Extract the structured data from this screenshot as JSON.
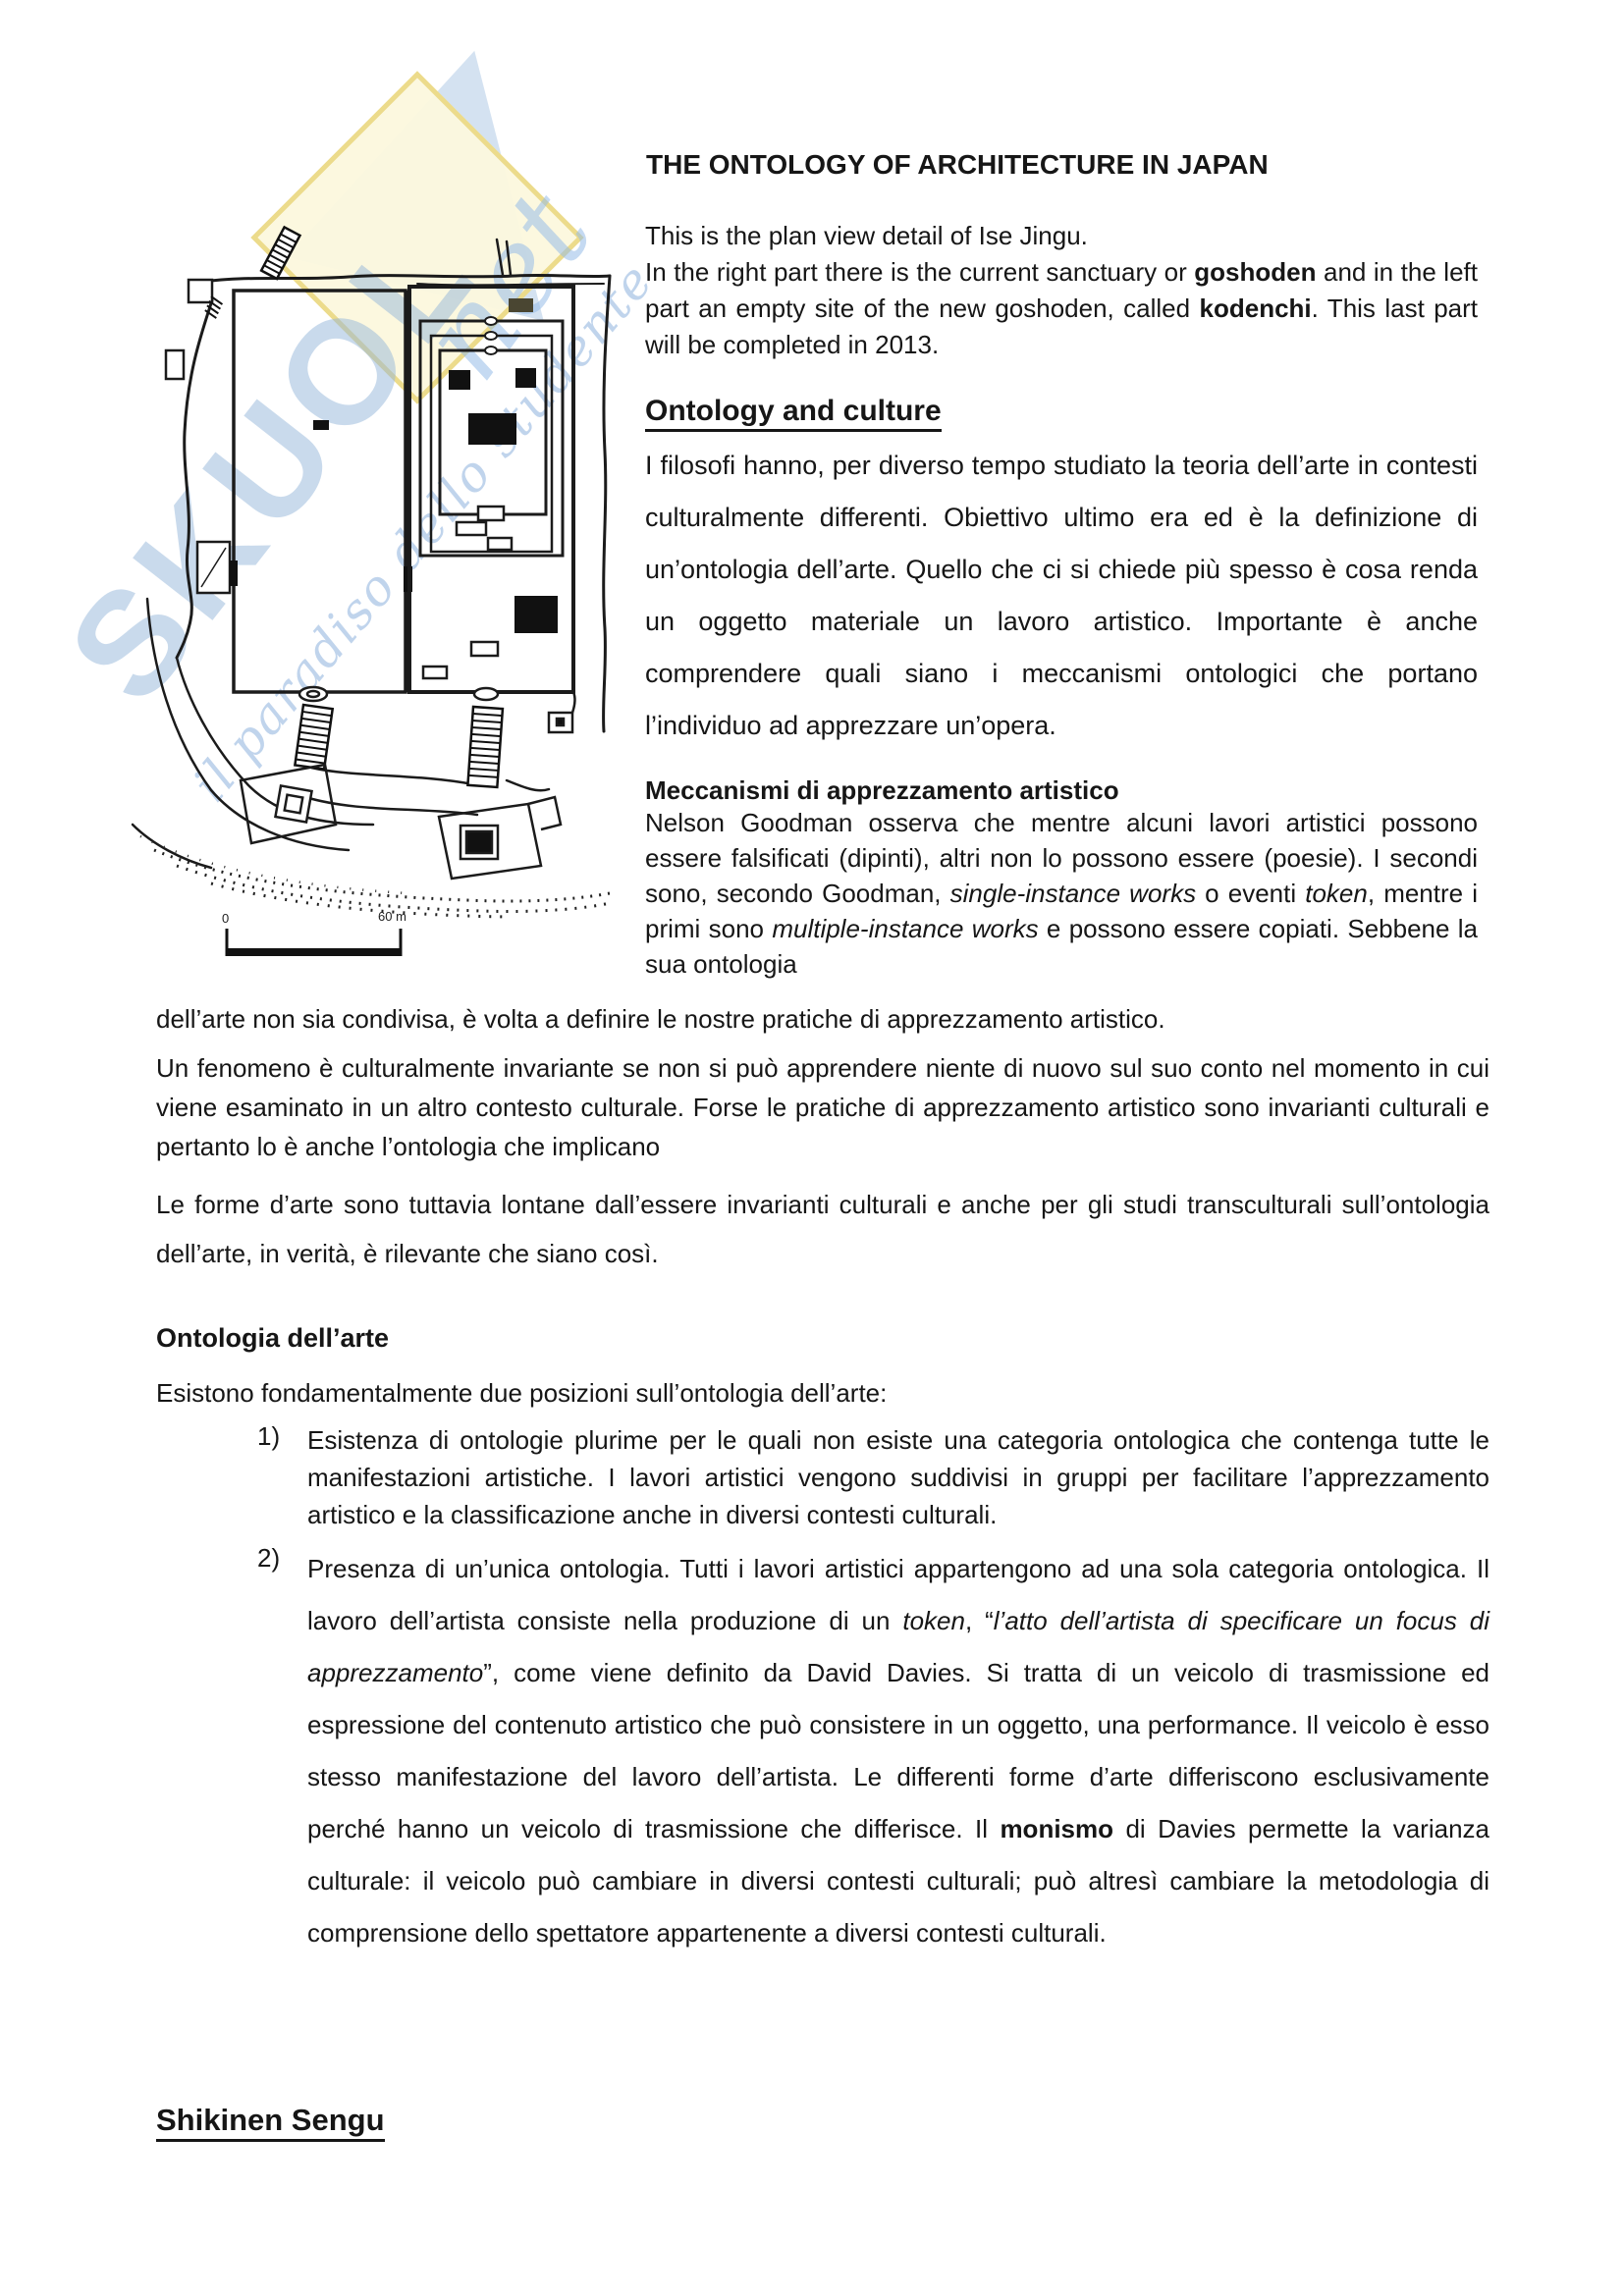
{
  "watermark": {
    "word": "SKUOL",
    "script_top": "net",
    "script_diag": "il paradiso dello studente",
    "colors": {
      "blue": "#94b5da",
      "pale_yellow": "#fcf8dd",
      "gold": "#e9d67c"
    }
  },
  "figure": {
    "scale_zero": "0",
    "scale_max": "60 m"
  },
  "title": "THE ONTOLOGY OF ARCHITECTURE IN JAPAN",
  "intro": {
    "rich": [
      {
        "t": "This is the plan view detail of Ise Jingu."
      },
      {
        "br": true
      },
      {
        "t": "In the right part there is the current sanctuary or "
      },
      {
        "t": "goshoden",
        "b": true
      },
      {
        "t": " and in the left part an empty site of the new goshoden, called "
      },
      {
        "t": "kodenchi",
        "b": true
      },
      {
        "t": ". This last part will be completed in 2013."
      }
    ]
  },
  "sections": {
    "ontology_culture": {
      "heading": "Ontology and culture",
      "body": "I filosofi hanno, per diverso tempo studiato la teoria dell’arte in contesti culturalmente differenti. Obiettivo ultimo era ed è la definizione di un’ontologia dell’arte. Quello che ci si chiede più spesso è cosa renda un oggetto materiale un lavoro artistico. Importante è anche comprendere quali siano i meccanismi ontologici che portano l’individuo ad apprezzare un’opera."
    },
    "meccanismi": {
      "heading": "Meccanismi di apprezzamento artistico",
      "body_rich": [
        {
          "t": "Nelson Goodman osserva che mentre alcuni lavori artistici possono essere falsificati (dipinti), altri non lo possono essere (poesie). I secondi sono, secondo Goodman, "
        },
        {
          "t": "single-instance works",
          "i": true
        },
        {
          "t": " o eventi "
        },
        {
          "t": "token",
          "i": true
        },
        {
          "t": ", mentre i primi sono "
        },
        {
          "t": "multiple-instance works",
          "i": true
        },
        {
          "t": " e possono essere copiati. Sebbene la sua ontologia"
        }
      ],
      "continuation": "dell’arte non sia condivisa, è volta a definire le nostre pratiche di apprezzamento artistico."
    },
    "para_un_fenomeno": "Un fenomeno è culturalmente invariante se non si può apprendere niente di nuovo sul suo conto nel momento in cui viene esaminato in un altro contesto culturale. Forse le pratiche di apprezzamento artistico sono invarianti culturali e pertanto lo è anche l’ontologia che implicano",
    "para_le_forme": "Le forme d’arte sono tuttavia lontane dall’essere invarianti culturali e anche per gli studi transculturali sull’ontologia dell’arte, in verità, è rilevante che siano così.",
    "ontologia_arte": {
      "heading": "Ontologia dell’arte",
      "intro_line": "Esistono fondamentalmente due posizioni sull’ontologia dell’arte:",
      "items": [
        {
          "num": "1)",
          "rich": [
            {
              "t": "Esistenza di ontologie plurime per le quali non esiste una categoria ontologica che contenga tutte le manifestazioni artistiche. I lavori artistici vengono suddivisi in gruppi per facilitare l’apprezzamento artistico e la classificazione anche in diversi contesti culturali."
            }
          ]
        },
        {
          "num": "2)",
          "rich": [
            {
              "t": "Presenza di un’unica ontologia. Tutti i lavori artistici appartengono ad una sola categoria ontologica. Il lavoro dell’artista consiste nella produzione di un "
            },
            {
              "t": "token",
              "i": true
            },
            {
              "t": ", “"
            },
            {
              "t": "l’atto dell’artista di specificare un focus di apprezzamento",
              "i": true
            },
            {
              "t": "”, come viene definito da David Davies. Si tratta di un veicolo di trasmissione ed espressione del contenuto artistico che può consistere in un oggetto, una performance. Il veicolo è esso stesso manifestazione del lavoro dell’artista. Le differenti forme d’arte differiscono esclusivamente perché hanno un veicolo di trasmissione che differisce. Il "
            },
            {
              "t": "monismo",
              "b": true
            },
            {
              "t": " di Davies permette la varianza culturale: il veicolo può cambiare in diversi contesti culturali; può altresì cambiare la metodologia di comprensione dello spettatore appartenente a diversi contesti culturali."
            }
          ]
        }
      ]
    },
    "shikinen": {
      "heading": "Shikinen Sengu"
    }
  }
}
